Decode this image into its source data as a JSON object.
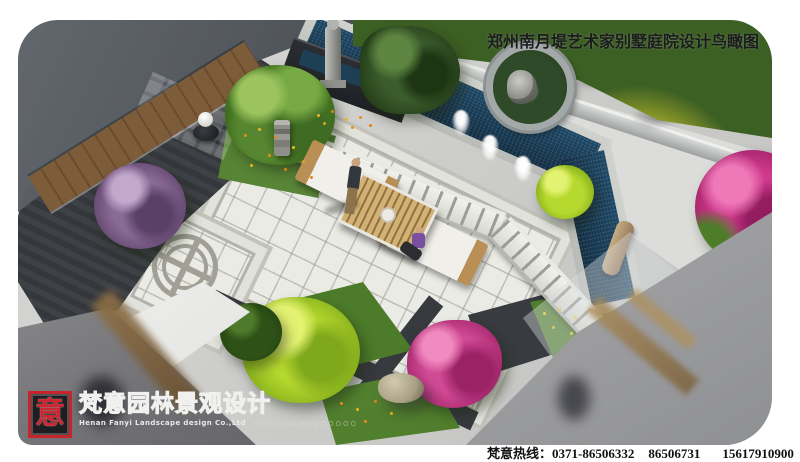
{
  "title": {
    "text": "郑州南月堤艺术家别墅庭院设计鸟瞰图"
  },
  "logo": {
    "seal_char": "意",
    "company_cn": "梵意园林景观设计",
    "company_en": "Henan Fanyi Landscape design Co.,Ltd",
    "dots": "○○○○○○○○○○○○○○"
  },
  "footer": {
    "hotline_label": "梵意热线：",
    "phone1": "0371-86506332",
    "phone2": "86506731",
    "phone3": "15617910900（孙）"
  },
  "colors": {
    "seal_red": "#c8242b",
    "pool_water": "#1d3e55",
    "plaza_paving": "#ebebe6",
    "charcoal_paving": "#34373b",
    "foliage_green": "#4e7d2a",
    "lime_bush": "#b6d92f",
    "magenta_blossom": "#cf3a8c",
    "title_text": "#1c1c1e",
    "hotline_text": "#111111"
  }
}
